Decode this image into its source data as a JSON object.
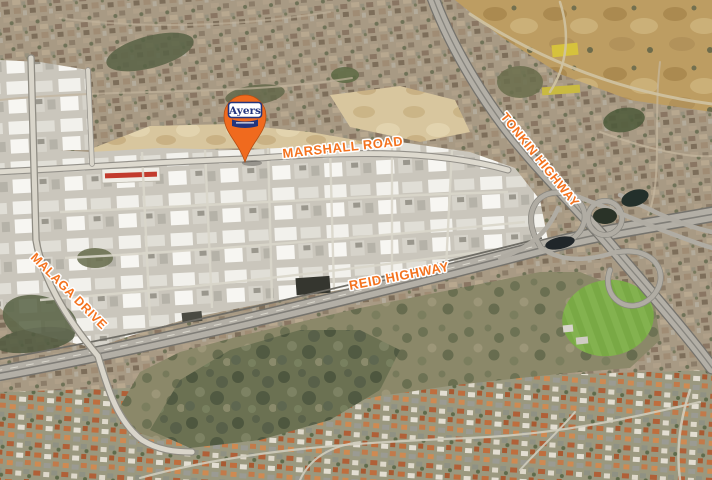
{
  "marker": {
    "label": "Ayers"
  },
  "roads": {
    "marshall": "MARSHALL ROAD",
    "tonkin": "TONKIN HIGHWAY",
    "reid": "REID HIGHWAY",
    "malaga": "MALAGA DRIVE"
  },
  "colors": {
    "road_label": "#f4731f",
    "road_label_outline": "#ffffff",
    "pin": "#f06a1e",
    "pin_outline": "#b54f15",
    "pin_text": "#23357e",
    "suburb_north": "#a89a84",
    "suburb_south": "#9a987f",
    "industrial": "#cac6bc",
    "bushland": "#6b7152",
    "oval_green": "#79a945",
    "field_gold": "#bd9d62",
    "sand": "#d8c69e",
    "highway": "#b3afa6",
    "minor_road": "#ddd9ce"
  }
}
